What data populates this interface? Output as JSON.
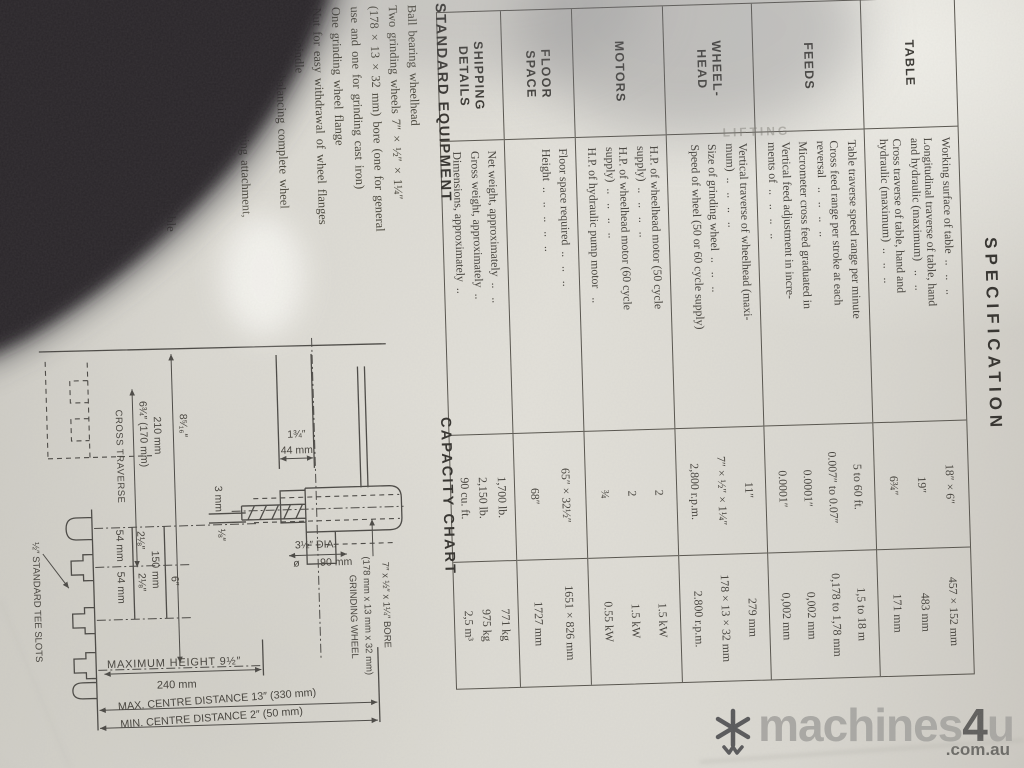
{
  "photo_colors": {
    "paper": "#dedbd3",
    "ink": "#44413b",
    "table_line": "#56534c",
    "finger_shadow": "#29282b",
    "watermark_gray": "#a6a5a1",
    "watermark_dark": "#5f5e5c",
    "watermark_domain": "#6b6a66"
  },
  "ghost_text": "LIFTING",
  "spec": {
    "title": "SPECIFICATION",
    "sections": [
      {
        "name_lines": [
          "TABLE"
        ],
        "items": [
          {
            "desc": [
              "Working surface of table  ..   ..   .."
            ],
            "imperial": "18″ × 6″",
            "metric": "457 × 152 mm"
          },
          {
            "desc": [
              "Longitudinal traverse of table, hand",
              "and hydraulic (maximum)   ..   .."
            ],
            "imperial": "19″",
            "metric": "483 mm"
          },
          {
            "desc": [
              "Cross traverse of table, hand and",
              "hydraulic (maximum)  ..   ..   .."
            ],
            "imperial": "6¾″",
            "metric": "171 mm"
          }
        ]
      },
      {
        "name_lines": [
          "FEEDS"
        ],
        "items": [
          {
            "desc": [
              "Table traverse speed range per minute"
            ],
            "imperial": "5 to 60 ft.",
            "metric": "1,5 to 18 m"
          },
          {
            "desc": [
              "Cross feed range per stroke at each",
              "reversal   ..   ..   ..   .."
            ],
            "imperial": "0.007″ to 0.07″",
            "metric": "0,178 to 1,78 mm"
          },
          {
            "desc": [
              "Micrometer cross feed graduated in"
            ],
            "imperial": "0.0001″",
            "metric": "0,002 mm"
          },
          {
            "desc": [
              "Vertical feed adjustment in incre-",
              "ments of  ..   ..   ..   .."
            ],
            "imperial": "0.0001″",
            "metric": "0,002 mm"
          }
        ]
      },
      {
        "name_lines": [
          "WHEEL-",
          "HEAD"
        ],
        "items": [
          {
            "desc": [
              "Vertical traverse of wheelhead (maxi-",
              "mum)  ..   ..   ..   .."
            ],
            "imperial": "11″",
            "metric": "279 mm"
          },
          {
            "desc": [
              "Size of grinding wheel  ..   ..   .."
            ],
            "imperial": "7″ × ½″ × 1¼″",
            "metric": "178 × 13 × 32 mm"
          },
          {
            "desc": [
              "Speed of wheel (50 or 60 cycle supply)"
            ],
            "imperial": "2,800 r.p.m.",
            "metric": "2.800 r.p.m."
          }
        ]
      },
      {
        "name_lines": [
          "MOTORS"
        ],
        "items": [
          {
            "desc": [
              "H.P. of wheelhead motor (50 cycle",
              "supply)  ..   ..   ..   .."
            ],
            "imperial": "2",
            "metric": "1.5 kW"
          },
          {
            "desc": [
              "H.P. of wheelhead motor (60 cycle",
              "supply)  ..   ..   ..   .."
            ],
            "imperial": "2",
            "metric": "1.5 kW"
          },
          {
            "desc": [
              "H.P. of hydraulic pump motor   .."
            ],
            "imperial": "¾",
            "metric": "0.55 kW"
          }
        ]
      },
      {
        "name_lines": [
          "FLOOR",
          "SPACE"
        ],
        "items": [
          {
            "desc": [
              "Floor space required  ..   ..   .."
            ],
            "imperial": "65″ × 32½″",
            "metric": "1651 × 826 mm"
          },
          {
            "desc": [
              "Height  ..   ..   ..   ..   .."
            ],
            "imperial": "68″",
            "metric": "1727 mm"
          }
        ]
      },
      {
        "name_lines": [
          "SHIPPING",
          "DETAILS"
        ],
        "items": [
          {
            "desc": [
              "Net weight, approximately  ..   .."
            ],
            "imperial": "1,700 lb.",
            "metric": "771 kg"
          },
          {
            "desc": [
              "Gross weight, approximately  .."
            ],
            "imperial": "2,150 lb.",
            "metric": "975 kg"
          },
          {
            "desc": [
              "Dimensions, approximately  .."
            ],
            "imperial": "90 cu. ft.",
            "metric": "2,5 m³"
          }
        ]
      }
    ]
  },
  "standard_equipment": {
    "heading": "STANDARD EQUIPMENT",
    "lines": [
      "Ball bearing wheelhead",
      "Two grinding wheels 7″ × ½″ × 1¼″",
      "(178 × 13 × 32 mm) bore (one for general",
      "use and one for grinding cast iron)",
      "One grinding wheel flange",
      "Nut for easy withdrawal of wheel flanges",
      "from spindle",
      "Mandrel for balancing complete wheel",
      "assembly",
      "Table mounted wheel truing attachment,",
      "without diamond",
      "Table and wheel guards",
      "Grease gun, spanners and wrenches",
      "Motors and electrical control gear suitable",
      "for operating on any standard 3 phase,",
      "A.C. supply."
    ]
  },
  "capacity_chart": {
    "heading": "CAPACITY CHART",
    "labels": {
      "dim_col_in": "1¾″",
      "dim_col_mm": "44 mm",
      "dia_in": "3½″ DIA.",
      "dia_sym": "ø",
      "dia_mm": "90 mm",
      "step_mm": "3 mm",
      "step_in": "⅛″",
      "trav_in": "8⁵⁄₁₆″",
      "trav_mm": "210 mm",
      "cross_val": "6¾″  (170 mm)",
      "cross_name": "CROSS TRAVERSE",
      "slot_in_a": "2⅛″",
      "slot_mm_a": "54 mm",
      "slot_in_b": "2⅛″",
      "slot_mm_b": "54 mm",
      "span_mm": "150 mm",
      "span_in": "6″",
      "max_height": "MAXIMUM HEIGHT 9½″",
      "max_height_mm": "240 mm",
      "max_centre": "MAX. CENTRE DISTANCE 13″ (330 mm)",
      "min_centre": "MIN. CENTRE DISTANCE 2″  (50 mm)",
      "tee_slots": "½″ STANDARD TEE SLOTS",
      "wheel_line1": "7″ x ½″ x 1¼″ BORE",
      "wheel_line2": "(178 mm x 13 mm x 32 mm)",
      "wheel_line3": "GRINDING WHEEL"
    }
  },
  "watermark": {
    "icon": "snowflake-asterisk",
    "brand": "machines",
    "accent_char": "4",
    "suffix": "u",
    "domain": ".com.au"
  }
}
